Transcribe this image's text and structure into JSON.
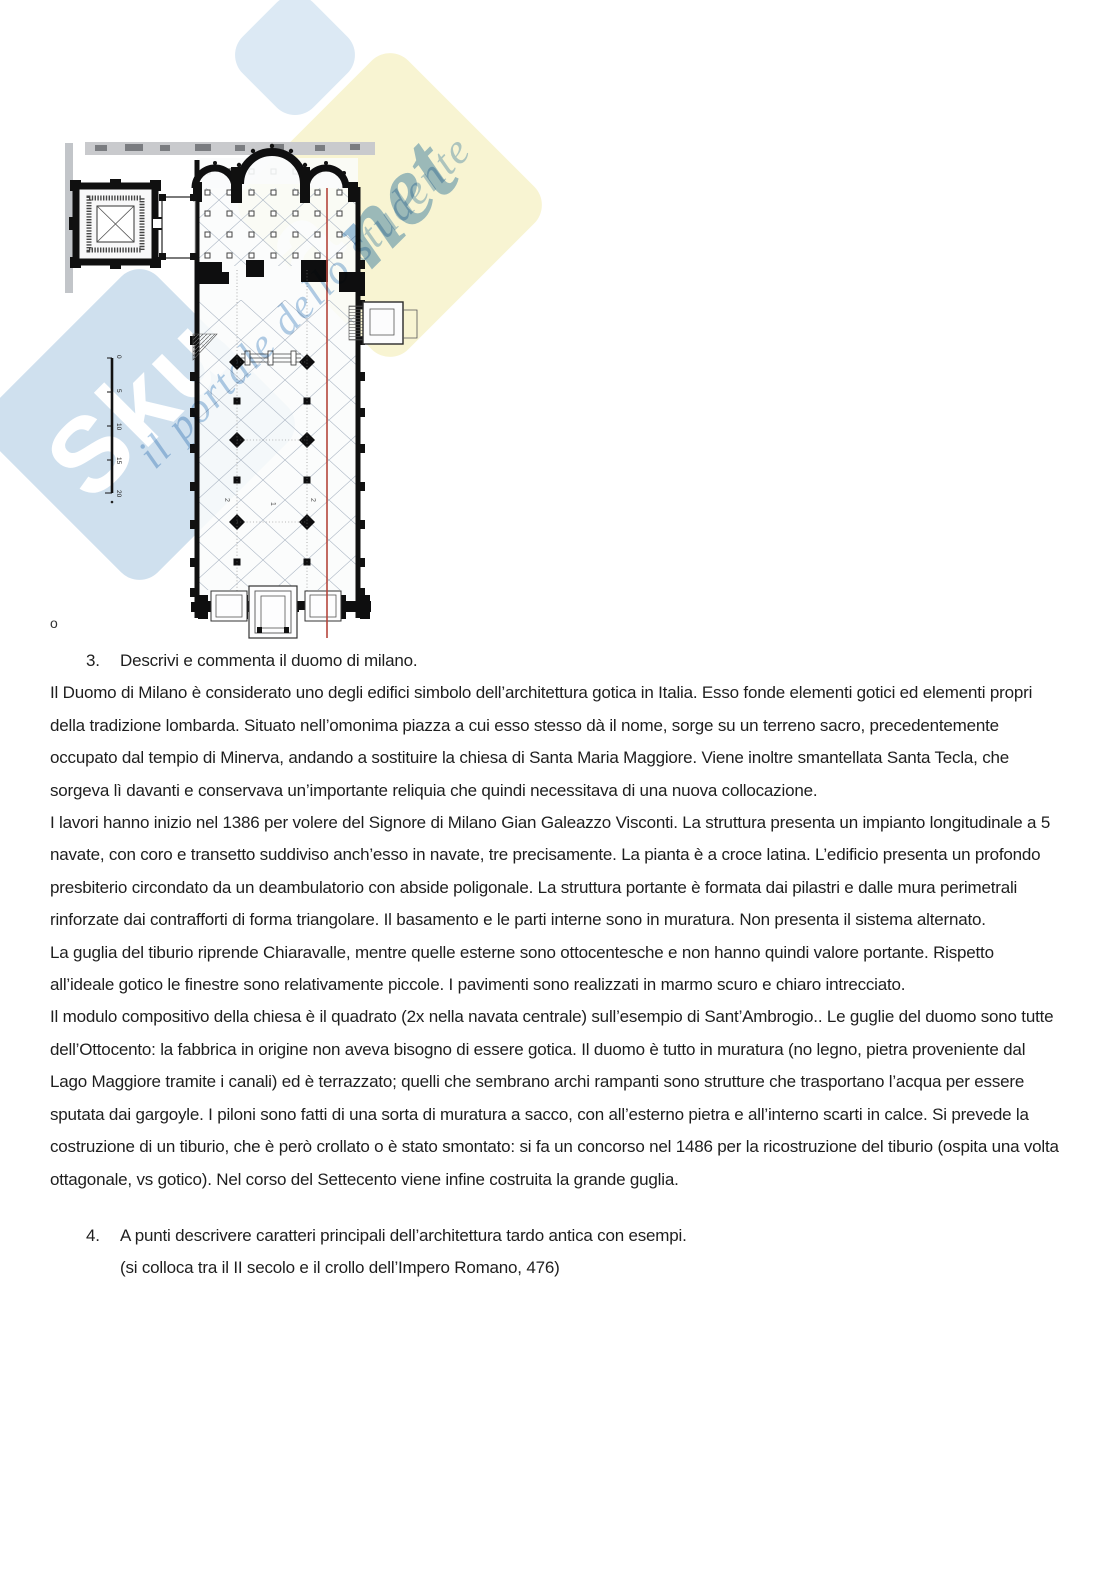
{
  "figure": {
    "watermark": {
      "brand_bold": "Skuola",
      "brand_script": "net",
      "tagline": "il portale dello studente",
      "colors": {
        "blue_tile": "#cfe0ee",
        "yellow_tile": "#f8f4d2",
        "script_blue": "#9fc2e0",
        "tagline_blue": "#b2cde6"
      }
    },
    "plan": {
      "description": "church-floor-plan",
      "scale_ticks": [
        "0",
        "5",
        "10",
        "15",
        "20"
      ],
      "nave_labels": [
        "2",
        "1",
        "2"
      ],
      "red_line_color": "#b5453c",
      "stray_mark": "o"
    }
  },
  "questions": {
    "q3": {
      "number": "3.",
      "text": "Descrivi e commenta il duomo di milano."
    },
    "q4": {
      "number": "4.",
      "text": "A punti descrivere caratteri principali dell’architettura tardo antica con esempi.",
      "subtext": "(si colloca tra il II secolo e il crollo dell’Impero Romano, 476)"
    }
  },
  "paragraphs": [
    "Il Duomo di Milano è considerato uno degli edifici simbolo dell’architettura gotica in Italia. Esso fonde elementi gotici ed elementi propri della tradizione lombarda. Situato nell’omonima piazza a cui esso stesso dà il nome, sorge su un terreno sacro, precedentemente occupato dal tempio di Minerva, andando a sostituire la chiesa di Santa Maria Maggiore. Viene inoltre smantellata Santa Tecla, che sorgeva lì davanti e conservava un’importante reliquia che quindi necessitava di una nuova collocazione.",
    "I lavori hanno inizio nel 1386 per volere del Signore di Milano Gian Galeazzo Visconti. La struttura presenta un impianto longitudinale a 5 navate, con coro e transetto suddiviso anch’esso in navate, tre precisamente. La pianta è a croce latina. L’edificio presenta un profondo presbiterio circondato da un deambulatorio con abside poligonale. La struttura portante è formata dai pilastri e dalle mura perimetrali rinforzate dai contrafforti di forma triangolare. Il basamento e le parti interne sono in muratura. Non presenta il sistema alternato.",
    "La guglia del tiburio riprende Chiaravalle, mentre quelle esterne sono ottocentesche e non hanno quindi valore portante. Rispetto all’ideale gotico le finestre sono relativamente piccole. I pavimenti sono realizzati in marmo scuro e chiaro intrecciato.",
    "Il modulo compositivo della chiesa è il quadrato (2x nella navata centrale) sull’esempio di Sant’Ambrogio.. Le guglie del duomo sono tutte dell’Ottocento: la fabbrica in origine non aveva bisogno di essere gotica. Il duomo è tutto in muratura (no legno, pietra proveniente dal Lago Maggiore tramite i canali) ed è terrazzato; quelli che sembrano archi rampanti sono strutture che trasportano l’acqua per essere sputata dai gargoyle. I piloni sono fatti di una sorta di muratura a sacco, con all’esterno pietra e all’interno scarti in calce. Si prevede la costruzione di un tiburio, che è però crollato o è stato smontato: si fa un concorso nel 1486 per la ricostruzione del tiburio (ospita una volta ottagonale, vs gotico). Nel corso del Settecento viene infine costruita la grande guglia."
  ]
}
